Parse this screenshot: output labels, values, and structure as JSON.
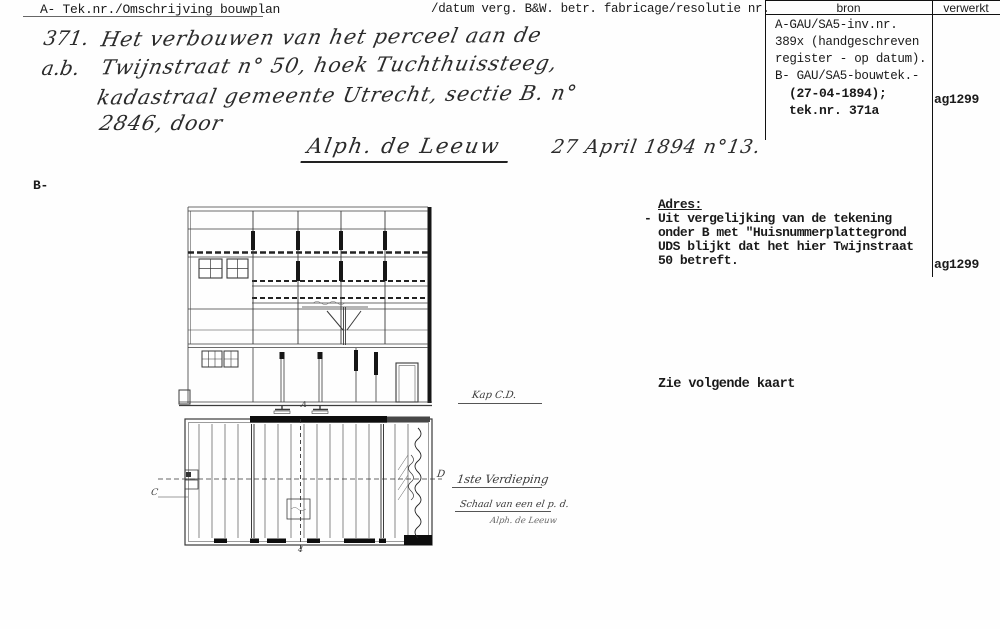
{
  "header": {
    "left": "A- Tek.nr./Omschrijving bouwplan",
    "middle": "/datum verg. B&W. betr. fabricage/resolutie nr.",
    "col_bron": "bron",
    "col_verwerkt": "verwerkt"
  },
  "bron_box": {
    "lines": [
      "A-GAU/SA5-inv.nr.",
      "389x (handgeschreven",
      "register - op datum).",
      "B- GAU/SA5-bouwtek.-"
    ],
    "bold_lines": [
      "(27-04-1894);",
      "tek.nr. 371a"
    ],
    "verwerkt_code": "ag1299"
  },
  "handwritten": {
    "nr": "371.",
    "ab": "a.b.",
    "line1": "Het verbouwen van het perceel aan de",
    "line2": "Twijnstraat n° 50, hoek Tuchthuissteeg,",
    "line3": "kadastraal gemeente Utrecht, sectie B. n°",
    "line4": "2846, door",
    "name": "Alph. de Leeuw",
    "date": "27 April 1894 n°13."
  },
  "label_b": "B-",
  "adres": {
    "title": "Adres:",
    "dash": "-",
    "lines": [
      "Uit vergelijking van de tekening",
      "onder B met \"Huisnummerplattegrond",
      "UDS blijkt dat het hier Twijnstraat",
      "50 betreft."
    ],
    "verwerkt_code": "ag1299"
  },
  "note": "Zie volgende kaart",
  "drawing": {
    "label_kap": "Kap C.D.",
    "label_c": "C",
    "label_d": "D",
    "label_a": "A",
    "label_4": "4",
    "label_floor": "1ste Verdieping",
    "label_scale": "Schaal van een el p. d.",
    "label_signature": "Alph. de Leeuw"
  },
  "colors": {
    "ink": "#1a1a1a",
    "paper": "#fefefe"
  }
}
